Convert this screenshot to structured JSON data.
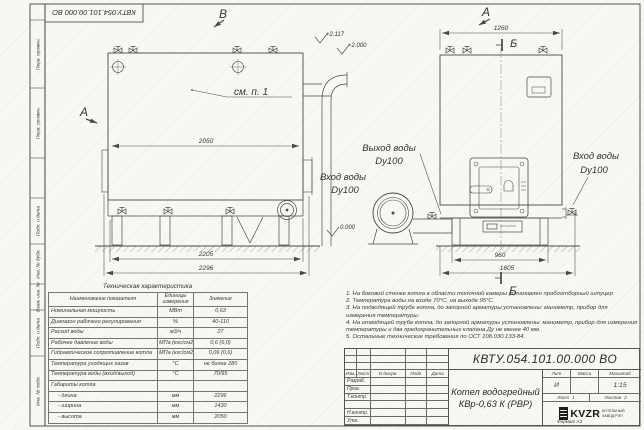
{
  "page": {
    "doc_number": "КВТУ.054.101.00.000 ВО"
  },
  "frame_strip": {
    "boxes": [
      "Перв. примен.",
      "Перв. примен.",
      "Подп. и дата",
      "Инв. № дубл.",
      "Взам. инв. №",
      "Подп. и дата",
      "Инв. № подл."
    ]
  },
  "drawing": {
    "view_labels": {
      "v_top": "В",
      "a_top": "А",
      "a_section": "А",
      "b_top": "Б",
      "b_bottom": "Б"
    },
    "callout": "см. п. 1",
    "elevations": {
      "e1": "+2.117",
      "e2": "+2.000",
      "e3": "0.000"
    },
    "dims": {
      "left_width": "2050",
      "left_base1": "2205",
      "left_base2": "2296",
      "right_top": "1260",
      "right_base1": "960",
      "right_base2": "1605"
    },
    "labels": {
      "outlet_line1": "Выход воды",
      "outlet_line2": "Dy100",
      "inlet_left_line1": "Вход воды",
      "inlet_left_line2": "Dy100",
      "inlet_right_line1": "Вход воды",
      "inlet_right_line2": "Dy100"
    }
  },
  "tech_table": {
    "title": "Техническая характеристика",
    "headers": [
      "Наименование показателя",
      "Единицы измерения",
      "Значение"
    ],
    "rows": [
      [
        "Номинальная мощность",
        "МВт",
        "0,63"
      ],
      [
        "Диапазон рабочего регулирования",
        "%",
        "40-110"
      ],
      [
        "Расход воды",
        "м3/ч",
        "27"
      ],
      [
        "Рабочее давление воды",
        "МПа (кгс/см2)",
        "0,6 (6,0)"
      ],
      [
        "Гидравлическое сопротивление котла",
        "МПа (кгс/см2)",
        "0,06 (0,6)"
      ],
      [
        "Температура уходящих газов",
        "°С",
        "не более 280"
      ],
      [
        "Температура воды (вход/выход)",
        "°С",
        "70/95"
      ],
      [
        "Габариты котла",
        "",
        ""
      ],
      [
        "- длина",
        "мм",
        "2296"
      ],
      [
        "- ширина",
        "мм",
        "1430"
      ],
      [
        "- высота",
        "мм",
        "2050"
      ]
    ]
  },
  "notes": {
    "items": [
      "1. На боковой стенке котла в области топочной камеры установлен пробоотборный штуцер",
      "2. Температура воды на входе 70°С, на выходе 95°С.",
      "3. На подводящей трубе котла, до запорной арматуры установлены: манометр, прибор для измерения температуры.",
      "4. На отводящей трубе котла, до запорной арматуры установлены: манометр, прибор для измерения температуры и два предохранительных клапана Ду не менее 40 мм.",
      "5. Остальные технические требования по ОСТ 108.030.133-84."
    ]
  },
  "title_block": {
    "doc_number": "КВТУ.054.101.00.000 ВО",
    "rev_header": [
      "Изм.",
      "Лист",
      "N докум.",
      "Подп.",
      "Дата"
    ],
    "row_labels": [
      "Разраб.",
      "Пров.",
      "Т.контр.",
      "",
      "Н.контр.",
      "Утв."
    ],
    "product_title_line1": "Котел водогрейный",
    "product_title_line2": "КВр-0,63 К (РВР)",
    "lit_label": "Лит",
    "lit_value": "И",
    "mass_label": "Масса",
    "mass_value": "",
    "scale_label": "Масштаб",
    "scale_value": "1:15",
    "sheet_label": "Лист",
    "sheet_value": "1",
    "sheets_label": "Листов",
    "sheets_value": "2",
    "logo_text": "KVZR",
    "logo_caption_line1": "КОТЕЛЬНЫЙ",
    "logo_caption_line2": "ЗАВОД РЭП",
    "format_text": "Формат  А3"
  }
}
